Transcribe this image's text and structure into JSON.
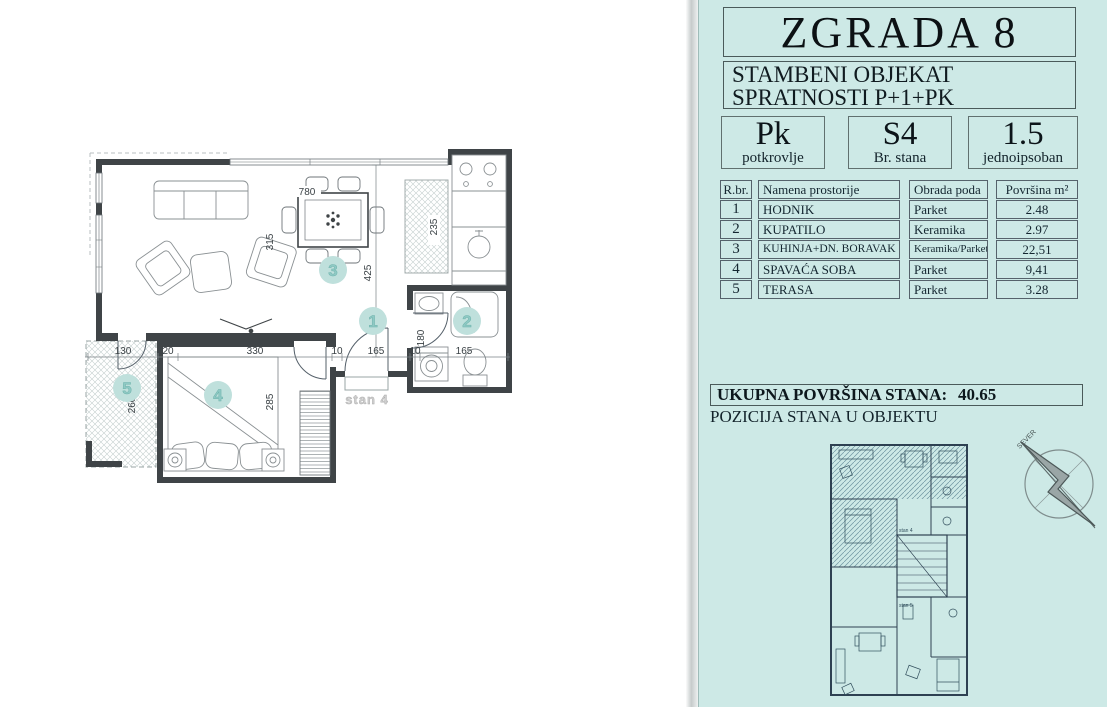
{
  "panel": {
    "building_title": "ZGRADA 8",
    "subtitle_line1": "STAMBENI OBJEKAT",
    "subtitle_line2": "SPRATNOSTI P+1+PK",
    "info_boxes": [
      {
        "value": "Pk",
        "label": "potkrovlje"
      },
      {
        "value": "S4",
        "label": "Br. stana"
      },
      {
        "value": "1.5",
        "label": "jednoipsoban"
      }
    ],
    "table": {
      "headers": {
        "num": "R.br.",
        "name": "Namena prostorije",
        "floor": "Obrada poda",
        "area": "Površina",
        "area_unit": "m²"
      },
      "rows": [
        {
          "num": "1",
          "name": "HODNIK",
          "floor": "Parket",
          "area": "2.48"
        },
        {
          "num": "2",
          "name": "KUPATILO",
          "floor": "Keramika",
          "area": "2.97"
        },
        {
          "num": "3",
          "name": "KUHINJA+DN. BORAVAK",
          "floor": "Keramika/Parket",
          "area": "22,51"
        },
        {
          "num": "4",
          "name": "SPAVAĆA SOBA",
          "floor": "Parket",
          "area": "9,41"
        },
        {
          "num": "5",
          "name": "TERASA",
          "floor": "Parket",
          "area": "3.28"
        }
      ]
    },
    "total_label": "UKUPNA POVRŠINA STANA:",
    "total_value": "40.65",
    "position_label": "POZICIJA STANA  U OBJEKTU",
    "compass_label": "SEVER"
  },
  "floorplan": {
    "unit_label": "stan 4",
    "badges": {
      "hall": "1",
      "bath": "2",
      "living": "3",
      "bedroom": "4",
      "terrace": "5"
    },
    "dims": {
      "top_width": "780",
      "pantry_h": "235",
      "living_w": "315",
      "hall_h": "425",
      "terrace_w": "130",
      "wall_a": "20",
      "bedroom_w": "330",
      "gap_a": "10",
      "entry_w": "165",
      "gap_b": "10",
      "bath_w": "165",
      "bath_h": "180",
      "terrace_h": "260",
      "bedroom_h": "285"
    },
    "mini": {
      "label_top": "stan 4",
      "label_bottom": "stan 5"
    }
  },
  "colors": {
    "panel_bg": "#cde9e6",
    "badge_fill": "#bfe0dc",
    "badge_text": "#8fc9c4",
    "wall": "#3f4447",
    "mini_line": "#2e4152"
  }
}
